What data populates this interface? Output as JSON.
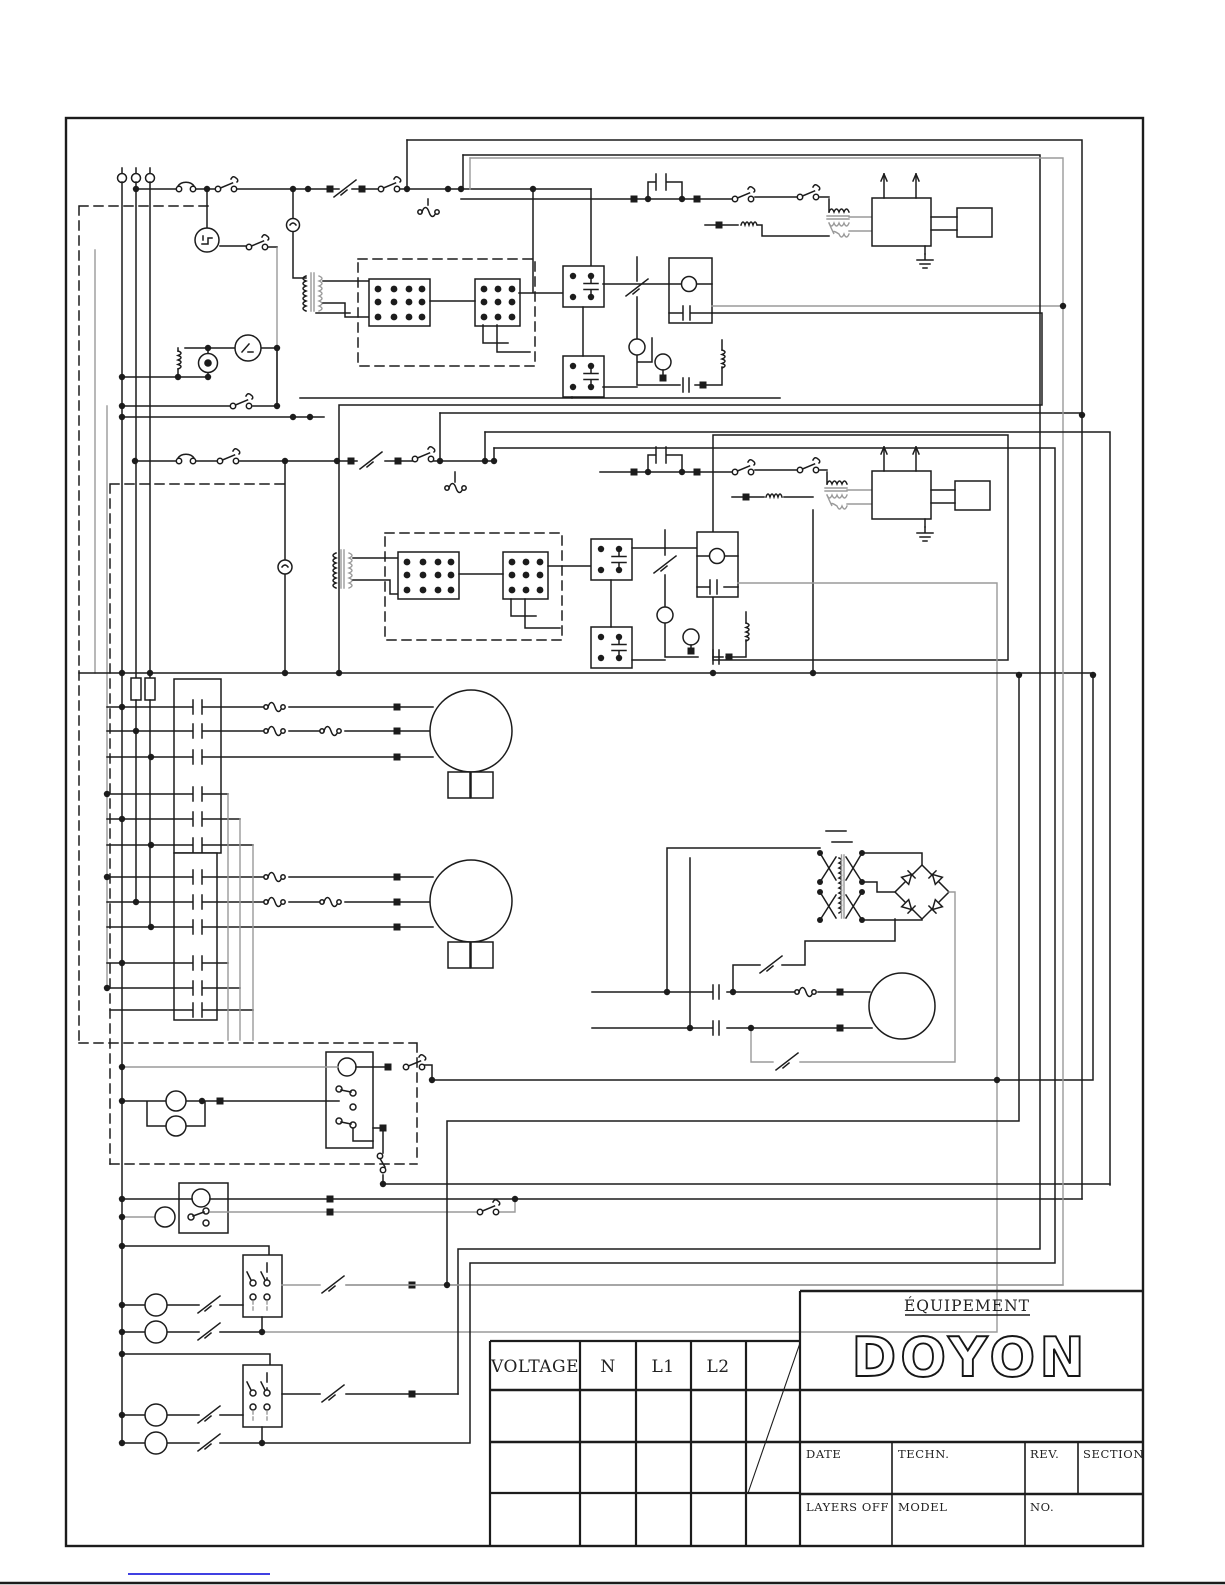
{
  "title_block": {
    "brand_top": "ÉQUIPEMENT",
    "brand": "DOYON",
    "voltage_label": "VOLTAGE",
    "n_label": "N",
    "l1_label": "L1",
    "l2_label": "L2",
    "date_label": "DATE",
    "techn_label": "TECHN.",
    "rev_label": "REV.",
    "section_label": "SECTION",
    "layers_label": "LAYERS  OFF",
    "model_label": "MODEL",
    "no_label": "NO."
  },
  "colors": {
    "wire": "#1c1c1c",
    "wire-gray": "#9a9a9a",
    "link": "#0000d9",
    "paper": "#ffffff"
  }
}
